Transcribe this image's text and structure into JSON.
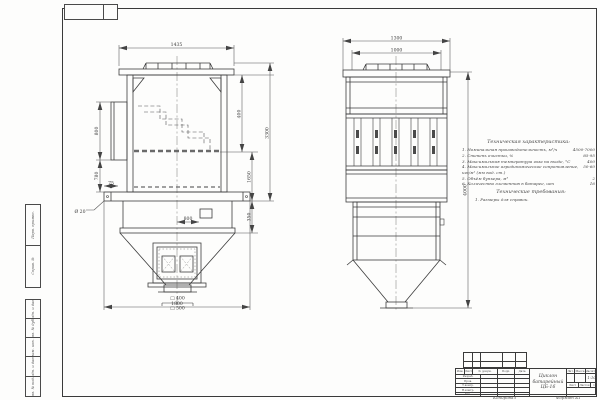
{
  "sheet": {
    "copied_label": "Копировал",
    "format_label": "Формат А1"
  },
  "margin_stamps": {
    "group_a": [
      "Перв. примен.",
      "Справ. №"
    ],
    "group_b": [
      "Подп. и дата",
      "Инв. № дубл.",
      "Взам. инв. №",
      "Подп. и дата",
      "Инв. № подл."
    ]
  },
  "front_view": {
    "dims": {
      "top_width": "1435",
      "left_upper": "800",
      "left_lower": "780",
      "right_upper": "400",
      "right_mid": "1650",
      "right_small": "350",
      "right_overall": "3300",
      "plate_hole": "Ø 20",
      "plate_small": "75",
      "center_small": "800",
      "outlet_inner": "□ 400",
      "outlet_outer": "□ 500",
      "bottom_width": "1800"
    }
  },
  "side_view": {
    "dims": {
      "top_outer": "1300",
      "top_inner": "1000",
      "overall_height": "4000"
    }
  },
  "tech_characteristics": {
    "title": "Техническая характеристика:",
    "items": [
      {
        "label": "1. Номинальная производительность, м³/ч",
        "value": "4500-7000"
      },
      {
        "label": "2. Степень очистки, %",
        "value": "85-95"
      },
      {
        "label": "3. Максимальная температура газа на входе, °С",
        "value": "400"
      },
      {
        "label": "4. Максимальное аэродинамическое сопротивление, кгс/м² (мм вод. ст.)",
        "value": "50-60"
      },
      {
        "label": "5. Объём бункера, м³",
        "value": "2"
      },
      {
        "label": "6. Количество элементов в батарее, шт",
        "value": "16"
      }
    ]
  },
  "tech_requirements": {
    "title": "Технические требования:",
    "items": [
      "1. Размеры для справок."
    ]
  },
  "title_block": {
    "header_cols": [
      "Изм.",
      "Лист",
      "№ докум.",
      "Подп.",
      "Дата"
    ],
    "roles": [
      "Разраб.",
      "Пров.",
      "Т.контр.",
      "Н.контр.",
      "Утв."
    ],
    "doc_name": [
      "Циклон",
      "батарейный",
      "ЦБ-16"
    ],
    "lit_label": "Лит.",
    "mass_label": "Масса",
    "scale_label": "Масштаб",
    "scale_value": "1:10",
    "sheet_label": "Лист",
    "sheets_label": "Листов",
    "sheets_value": "1"
  }
}
